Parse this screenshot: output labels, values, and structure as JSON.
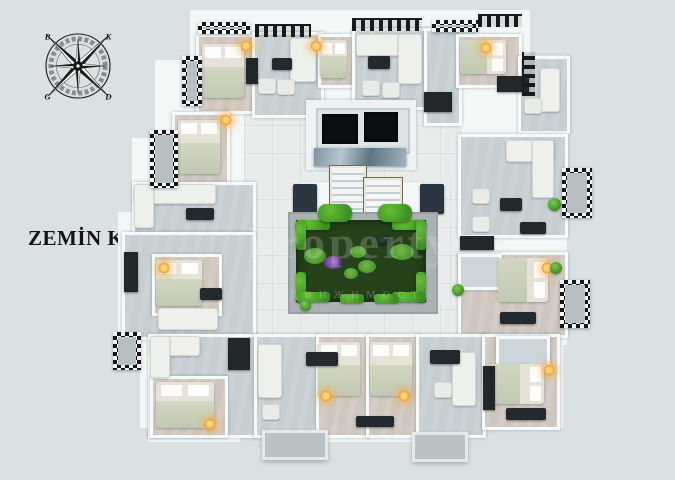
{
  "title": {
    "text": "ZEMİN KAT"
  },
  "compass": {
    "north": "K",
    "east": "D",
    "south": "G",
    "west": "B"
  },
  "watermark": {
    "line1": "Property",
    "line2": "недвижимость"
  },
  "palette": {
    "background": "#d9e1e3",
    "wall_white": "#f3f7f7",
    "pavement": "#e8edec",
    "living_floor": "#c5ced1",
    "bedroom_floor": "#cfc6bd",
    "garden_green": "#25421b",
    "hedge_green": "#49a62a",
    "elevator_shaft": "#0c1013",
    "dark_furniture": "#24292d",
    "navy_bench": "#2b3542",
    "lamp_glow": "#f0a030"
  }
}
